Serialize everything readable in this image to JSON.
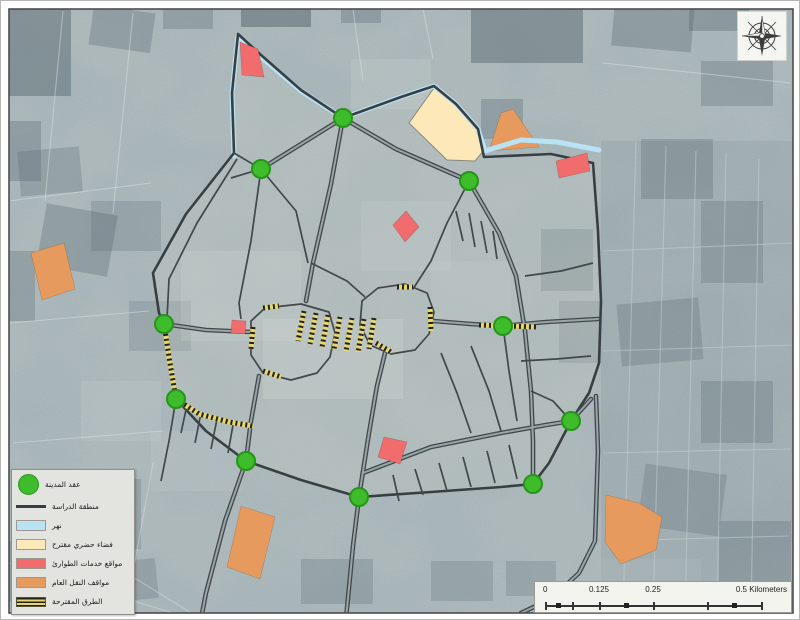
{
  "legend": {
    "items": [
      {
        "label": "عقد المدينة",
        "swatch": "circle",
        "color": "#3ebc2b"
      },
      {
        "label": "منطقة الدراسة",
        "swatch": "line",
        "color": "#383f43"
      },
      {
        "label": "نهر",
        "swatch": "rect",
        "color": "#b9e2f4"
      },
      {
        "label": "فضاء حضري مقترح",
        "swatch": "rect",
        "color": "#fce8b8"
      },
      {
        "label": "مواقع خدمات الطوارئ",
        "swatch": "rect",
        "color": "#f16c6c"
      },
      {
        "label": "مواقف النقل العام",
        "swatch": "rect",
        "color": "#e69a5d"
      },
      {
        "label": "الطرق المقترحة",
        "swatch": "hatch",
        "color": "#e6d66d"
      }
    ]
  },
  "scale_bar": {
    "labels": [
      "0",
      "0.125",
      "0.25",
      "0.5 Kilometers"
    ]
  },
  "north_arrow": {
    "icon": "compass-rose"
  },
  "map": {
    "colors": {
      "base": "#a9b4b6",
      "patch_dark": "#53646c",
      "patch_light": "#d2dad7",
      "street": "#d8e0df",
      "road": "#41474b",
      "road_core": "#9aa5a8",
      "boundary": "#383f43",
      "inside_tint": "#cfd2c8",
      "river": "#b9e2f4",
      "hatch_yellow": "#e6d66d",
      "hatch_black": "#23231c",
      "node_fill": "#3ebc2b",
      "node_stroke": "#259618",
      "cream": "#fce8b8",
      "cream_stroke": "#8a8a7a",
      "orange": "#e69a5d",
      "red": "#f16c6c"
    },
    "geometry": {
      "boundary": "M237,33 L231,92 L233,152 L185,213 L152,272 L158,312 L163,323 L169,362 L175,398 L205,430 L245,460 L300,479 L358,496 L430,491 L500,486 L532,483 L548,462 L570,420 L588,392 L598,362 L600,300 L597,230 L592,162 L550,153 L483,156 L477,128 L455,103 L433,85 L400,96 L342,117 L300,89 L260,54 Z",
      "river": "M233,155 L231,92 L237,35 L260,56 L300,90 L342,117 L400,96 L433,85 L455,103 L477,128 L484,150 L520,139 L556,141 L598,149",
      "major_roads": [
        "M260,168 L342,117",
        "M342,117 L330,183 L312,262 L305,300",
        "M258,375 L250,420 L245,460 L224,520 L205,592 L200,618",
        "M384,352 L376,385 L368,432 L358,496 L352,545 L345,618",
        "M342,117 L395,148 L468,180",
        "M163,323 L205,329 L250,331",
        "M432,320 L470,323 L502,325 L545,321 L597,318",
        "M362,472 L430,446 L500,432 L545,424 L570,420",
        "M468,180 L498,232 L515,275 L524,330 L530,390 L532,440 L532,483",
        "M595,395 L597,450 L594,540 L578,572 L550,598 L520,612",
        "M570,420 L590,398"
      ],
      "minor_roads": [
        "M260,168 L250,240 L238,302 L240,318",
        "M260,168 L295,210 L307,262",
        "M233,152 L260,168",
        "M230,177 L260,168",
        "M236,158 L196,222 L168,278 L166,318",
        "M468,180 L446,222 L430,260 L412,288",
        "M455,210 L462,240",
        "M468,212 L474,246",
        "M480,220 L486,252",
        "M492,230 L496,258",
        "M310,262 L346,280 L364,296",
        "M250,320 L264,307 L300,303 L328,311 L334,332 L329,356 L316,372 L290,379 L262,372 L250,354 Z",
        "M361,300 L377,287 L404,283 L426,292 L433,311 L428,333 L414,349 L390,353 L369,344 L359,324 Z",
        "M392,474 L398,500",
        "M414,468 L422,494",
        "M438,462 L446,490",
        "M462,456 L470,486",
        "M486,450 L494,482",
        "M508,444 L516,478",
        "M186,404 L180,432",
        "M200,412 L194,442",
        "M216,418 L210,448",
        "M232,424 L227,452",
        "M175,398 L168,440 L160,480",
        "M440,352 L456,392 L470,432",
        "M470,345 L488,390 L500,430",
        "M502,325 L508,370 L516,420",
        "M524,275 L560,270 L592,262",
        "M520,360 L555,358 L590,355",
        "M570,420 L552,400 L530,390"
      ],
      "hatched_roads": [
        "M163,323 L169,362 L175,398",
        "M175,398 L198,413 L228,421 L252,425",
        "M303,310 L297,340",
        "M315,312 L309,343",
        "M327,314 L321,346",
        "M339,316 L333,348",
        "M351,317 L345,350",
        "M363,318 L357,351",
        "M373,317 L368,348",
        "M252,326 L250,348",
        "M262,307 L278,305",
        "M262,370 L280,376",
        "M396,286 L412,286",
        "M429,306 L430,330",
        "M375,342 L390,351",
        "M478,324 L535,326"
      ],
      "nodes": [
        [
          342,
          117
        ],
        [
          260,
          168
        ],
        [
          468,
          180
        ],
        [
          163,
          323
        ],
        [
          502,
          325
        ],
        [
          175,
          398
        ],
        [
          245,
          460
        ],
        [
          358,
          496
        ],
        [
          532,
          483
        ],
        [
          570,
          420
        ]
      ],
      "cream_polygons": [
        "433,87 456,104 477,129 484,148 474,160 446,159 408,122"
      ],
      "orange_polygons": [
        "30,252 63,242 74,288 41,299",
        "488,150 500,112 512,108 538,146",
        "240,505 274,516 259,578 226,566",
        "605,494 638,502 661,516 655,549 620,563 604,541"
      ],
      "red_polygons": [
        "239,41 257,48 263,76 241,74",
        "555,160 586,152 589,170 558,177",
        "405,210 418,226 404,241 392,224",
        "231,319 245,320 244,333 230,332",
        "383,436 406,441 399,463 377,456"
      ],
      "sat_dark_patches": [
        [
          0,
          0,
          70,
          95,
          0,
          0.45
        ],
        [
          90,
          8,
          62,
          40,
          8,
          0.3
        ],
        [
          162,
          0,
          50,
          28,
          0,
          0.28
        ],
        [
          240,
          0,
          70,
          26,
          0,
          0.5
        ],
        [
          470,
          0,
          112,
          62,
          0,
          0.45
        ],
        [
          612,
          0,
          80,
          48,
          5,
          0.32
        ],
        [
          700,
          60,
          72,
          45,
          0,
          0.28
        ],
        [
          688,
          0,
          60,
          30,
          0,
          0.35
        ],
        [
          18,
          148,
          62,
          45,
          -5,
          0.26
        ],
        [
          40,
          208,
          72,
          62,
          10,
          0.3
        ],
        [
          90,
          200,
          70,
          50,
          0,
          0.22
        ],
        [
          0,
          120,
          40,
          60,
          0,
          0.3
        ],
        [
          0,
          250,
          34,
          70,
          0,
          0.28
        ],
        [
          640,
          138,
          72,
          60,
          0,
          0.28
        ],
        [
          700,
          200,
          62,
          82,
          0,
          0.25
        ],
        [
          618,
          300,
          82,
          62,
          -5,
          0.26
        ],
        [
          700,
          380,
          72,
          62,
          0,
          0.26
        ],
        [
          640,
          468,
          82,
          62,
          8,
          0.24
        ],
        [
          718,
          520,
          72,
          60,
          0,
          0.26
        ],
        [
          58,
          478,
          82,
          70,
          0,
          0.24
        ],
        [
          0,
          540,
          92,
          60,
          0,
          0.26
        ],
        [
          128,
          300,
          62,
          50,
          0,
          0.2
        ],
        [
          540,
          228,
          52,
          62,
          0,
          0.26
        ],
        [
          558,
          300,
          42,
          62,
          0,
          0.2
        ],
        [
          300,
          558,
          72,
          45,
          0,
          0.24
        ],
        [
          430,
          560,
          62,
          40,
          0,
          0.22
        ],
        [
          480,
          98,
          42,
          40,
          0,
          0.3
        ],
        [
          340,
          0,
          40,
          22,
          0,
          0.3
        ],
        [
          96,
          560,
          60,
          40,
          -6,
          0.25
        ],
        [
          505,
          560,
          50,
          35,
          0,
          0.22
        ]
      ],
      "sat_light_patches": [
        [
          180,
          250,
          120,
          90,
          0,
          0.22
        ],
        [
          262,
          318,
          140,
          80,
          0,
          0.28
        ],
        [
          360,
          200,
          90,
          70,
          0,
          0.18
        ],
        [
          80,
          380,
          80,
          60,
          0,
          0.16
        ],
        [
          600,
          558,
          100,
          42,
          0,
          0.15
        ],
        [
          350,
          58,
          80,
          50,
          0,
          0.2
        ],
        [
          150,
          430,
          90,
          60,
          0,
          0.15
        ],
        [
          430,
          260,
          80,
          60,
          0,
          0.15
        ]
      ],
      "sat_streets": [
        "M635,140 L622,612",
        "M665,145 L652,612",
        "M695,150 L684,612",
        "M725,152 L716,612",
        "M758,158 L750,612",
        "M602,250 L792,242",
        "M602,350 L792,344",
        "M602,452 L790,448",
        "M605,540 L788,535",
        "M8,200 L150,182",
        "M8,322 L148,310",
        "M12,442 L162,430",
        "M62,10 L44,200",
        "M132,12 L112,212",
        "M12,502 L200,618",
        "M8,562 L182,615",
        "M152,462 L124,615",
        "M352,8 L362,80",
        "M422,8 L432,58",
        "M602,62 L790,82"
      ]
    }
  }
}
